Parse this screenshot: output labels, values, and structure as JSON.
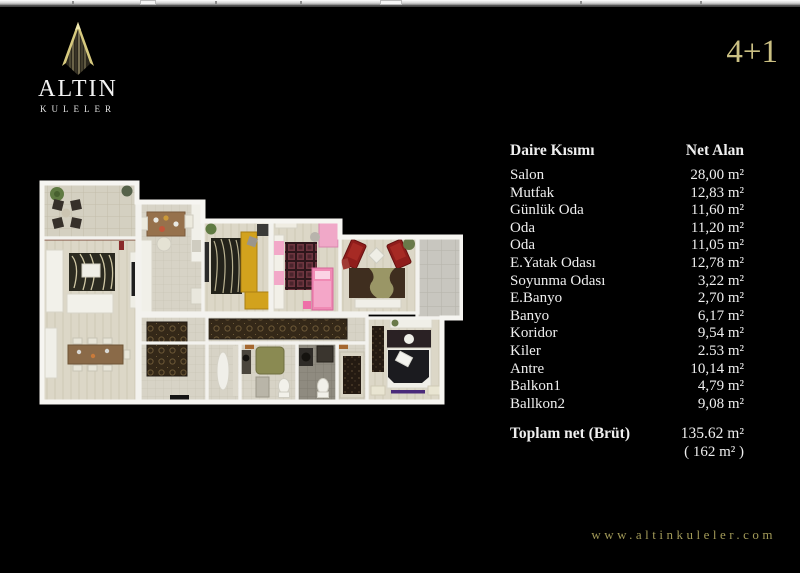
{
  "brand": {
    "name": "ALTIN",
    "subname": "KULELER"
  },
  "plan_type": "4+1",
  "table": {
    "col_section": "Daire Kısımı",
    "col_area": "Net Alan",
    "rows": [
      {
        "label": "Salon",
        "value": "28,00 m²"
      },
      {
        "label": "Mutfak",
        "value": "12,83 m²"
      },
      {
        "label": "Günlük Oda",
        "value": "11,60 m²"
      },
      {
        "label": "Oda",
        "value": "11,20 m²"
      },
      {
        "label": "Oda",
        "value": "11,05 m²"
      },
      {
        "label": "E.Yatak Odası",
        "value": "12,78 m²"
      },
      {
        "label": "Soyunma Odası",
        "value": "3,22 m²"
      },
      {
        "label": "E.Banyo",
        "value": "2,70 m²"
      },
      {
        "label": "Banyo",
        "value": "6,17 m²"
      },
      {
        "label": "Koridor",
        "value": "9,54 m²"
      },
      {
        "label": "Kiler",
        "value": "2.53 m²"
      },
      {
        "label": "Antre",
        "value": "10,14 m²"
      },
      {
        "label": "Balkon1",
        "value": "4,79 m²"
      },
      {
        "label": "Ballkon2",
        "value": "9,08 m²"
      }
    ],
    "total_label": "Toplam net (Brüt)",
    "total_value": "135.62 m²",
    "total_gross": "( 162 m² )"
  },
  "footer": {
    "website": "www.altinkuleler.com"
  },
  "colors": {
    "background": "#000000",
    "gold": "#cbc083",
    "text": "#efefef",
    "url_gold": "#a29a58",
    "wall_white": "#f3f2ee",
    "floor_beige": "#d7d3c6",
    "accent_red": "#8f1d1b",
    "accent_yellow": "#d2a21d",
    "accent_pink": "#f08ab4"
  }
}
